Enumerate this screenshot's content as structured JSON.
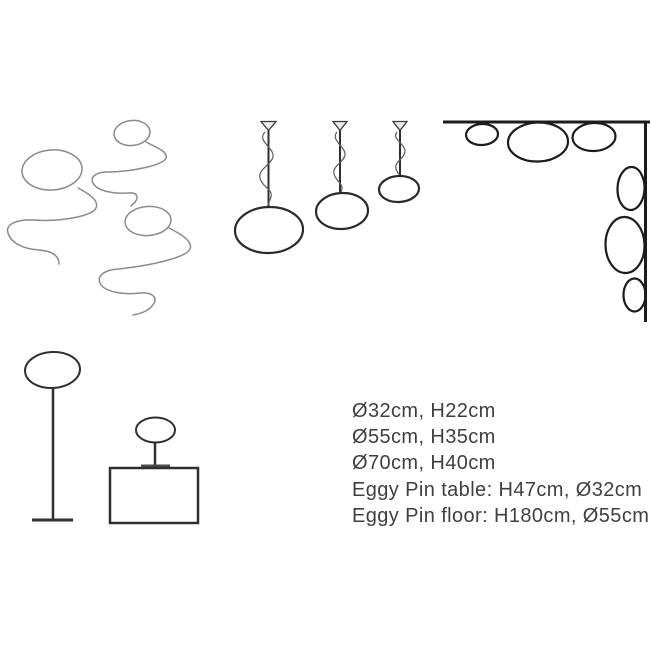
{
  "specs": {
    "lines": [
      "Ø32cm, H22cm",
      "Ø55cm, H35cm",
      "Ø70cm, H40cm",
      "Eggy Pin table: H47cm, Ø32cm",
      "Eggy Pin floor: H180cm, Ø55cm"
    ]
  },
  "illustrations": {
    "sketch_lamps": "lamps-with-squiggly-cords-sketch",
    "pendant_lamps": "three-pendant-lamps",
    "corner_lamps": "corner-mounted-oval-lamps",
    "floor_lamp": "eggy-pin-floor-lamp",
    "table_lamp": "eggy-pin-table-lamp-on-cabinet"
  },
  "colors": {
    "background": "#ffffff",
    "sketch_line": "#8a8a8a",
    "drawing_line": "#2f2f2f",
    "corner_line": "#1c1c1c",
    "text": "#3f3f3f"
  }
}
